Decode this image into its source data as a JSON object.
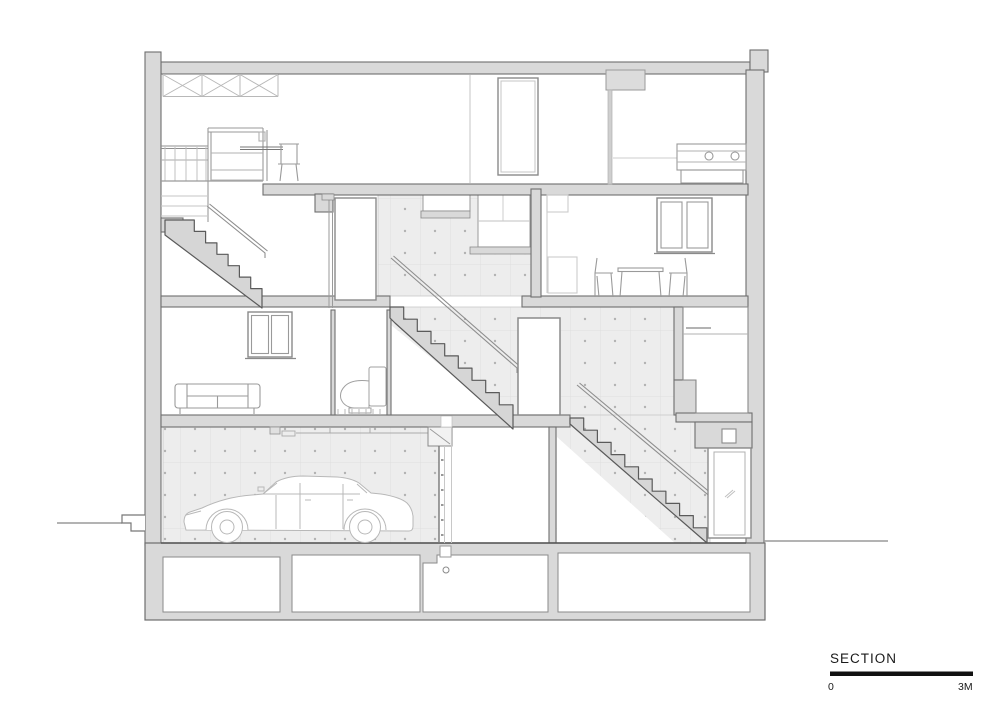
{
  "title": {
    "text": "SECTION"
  },
  "scale_bar": {
    "start": "0",
    "end": "3M"
  },
  "colors": {
    "poche": "#d9d9d9",
    "concrete": "#ededed",
    "concrete_dot": "#b2b2b2",
    "outline": "#6e6e6e",
    "stair_line": "#5a5a5a",
    "rail": "#8f8f8f",
    "furniture": "#9a9a9a",
    "vehicle": "#b8b8b8",
    "text": "#1a1a1a",
    "scale_bar_fill": "#111111"
  }
}
